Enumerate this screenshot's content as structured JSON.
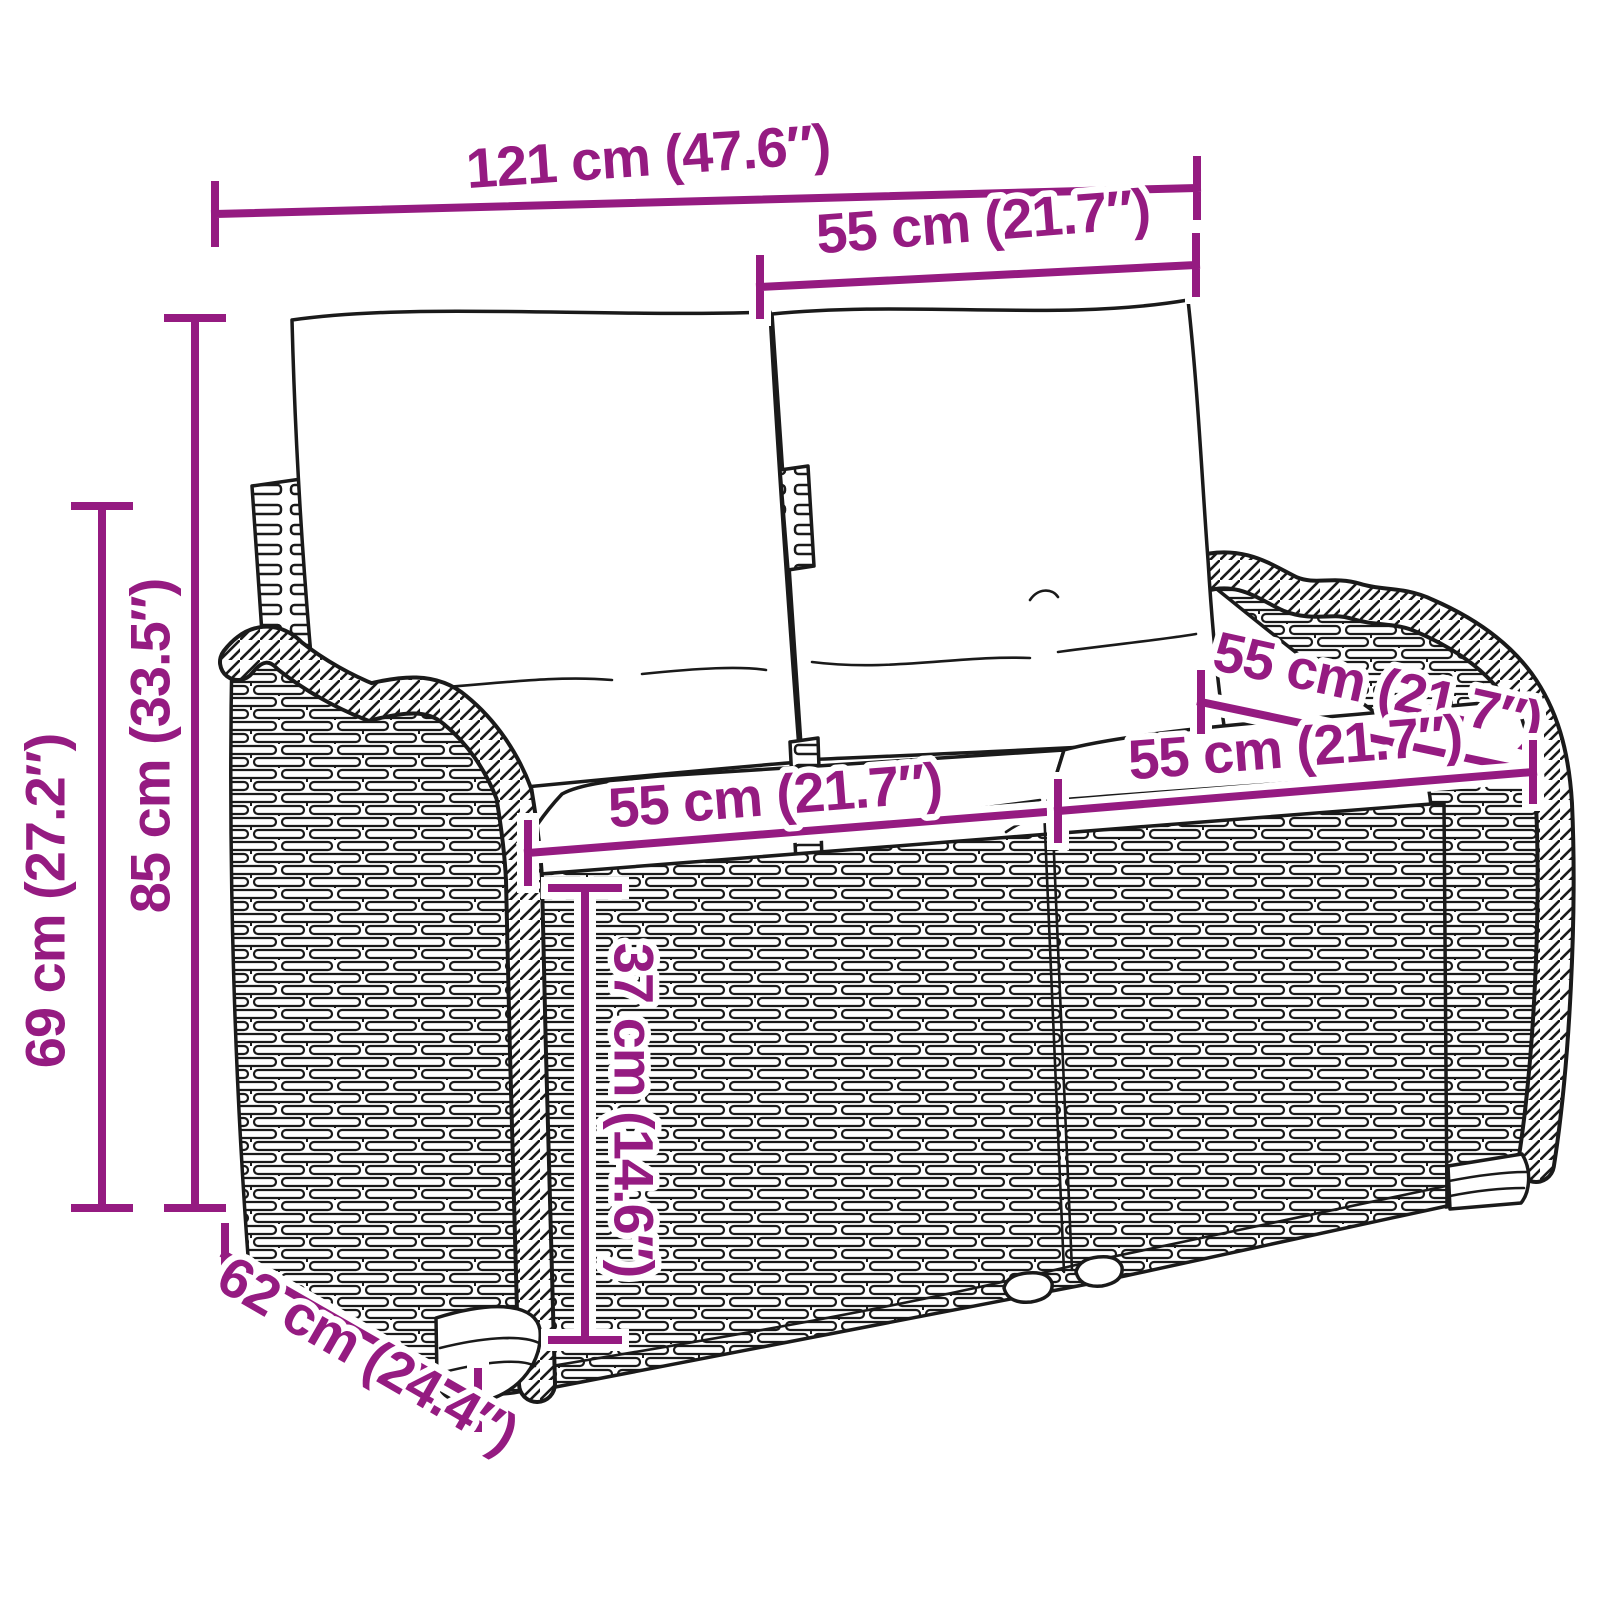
{
  "diagram": {
    "colors": {
      "accent": "#951B81",
      "ink": "#1A1A1A",
      "background": "#FFFFFF"
    },
    "dimensions": {
      "total_width": "121 cm (47.6″)",
      "backrest_cushion_width": "55 cm (21.7″)",
      "total_height": "85 cm (33.5″)",
      "backrest_height": "69 cm (27.2″)",
      "seat_cushion_width_left": "55 cm (21.7″)",
      "seat_depth": "55 cm (21.7″)",
      "seat_cushion_width_right": "55 cm (21.7″)",
      "seat_height": "37 cm (14.6″)",
      "total_depth": "62 cm (24.4″)"
    }
  }
}
